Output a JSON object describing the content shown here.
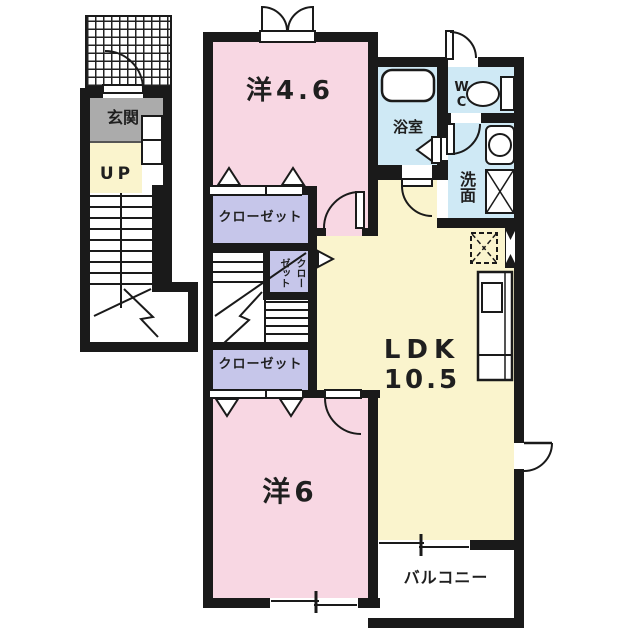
{
  "plan": {
    "type": "floorplan",
    "unit_rooms": {
      "entrance_label": "玄関",
      "stairs_up_label": "UP",
      "bedroom1_label": "洋4.6",
      "closet1_label": "クローゼット",
      "closet_small_label": "クローゼット",
      "bathroom_label": "浴室",
      "toilet_label": "WC",
      "washroom_label": "洗面",
      "ldk_label": "LDK",
      "ldk_size_label": "10.5",
      "bedroom2_label": "洋6",
      "closet2_label": "クローゼット",
      "balcony_label": "バルコニー"
    },
    "colors": {
      "wall": "#1a1a1a",
      "bedroom_pink": "#f8d7e3",
      "ldk_yellow": "#faf4cd",
      "wet_area_blue": "#cfe9f5",
      "closet_lavender": "#c6c6ea",
      "entrance_gray": "#ababab",
      "floor_white": "#ffffff",
      "text": "#1f1f1f"
    }
  }
}
